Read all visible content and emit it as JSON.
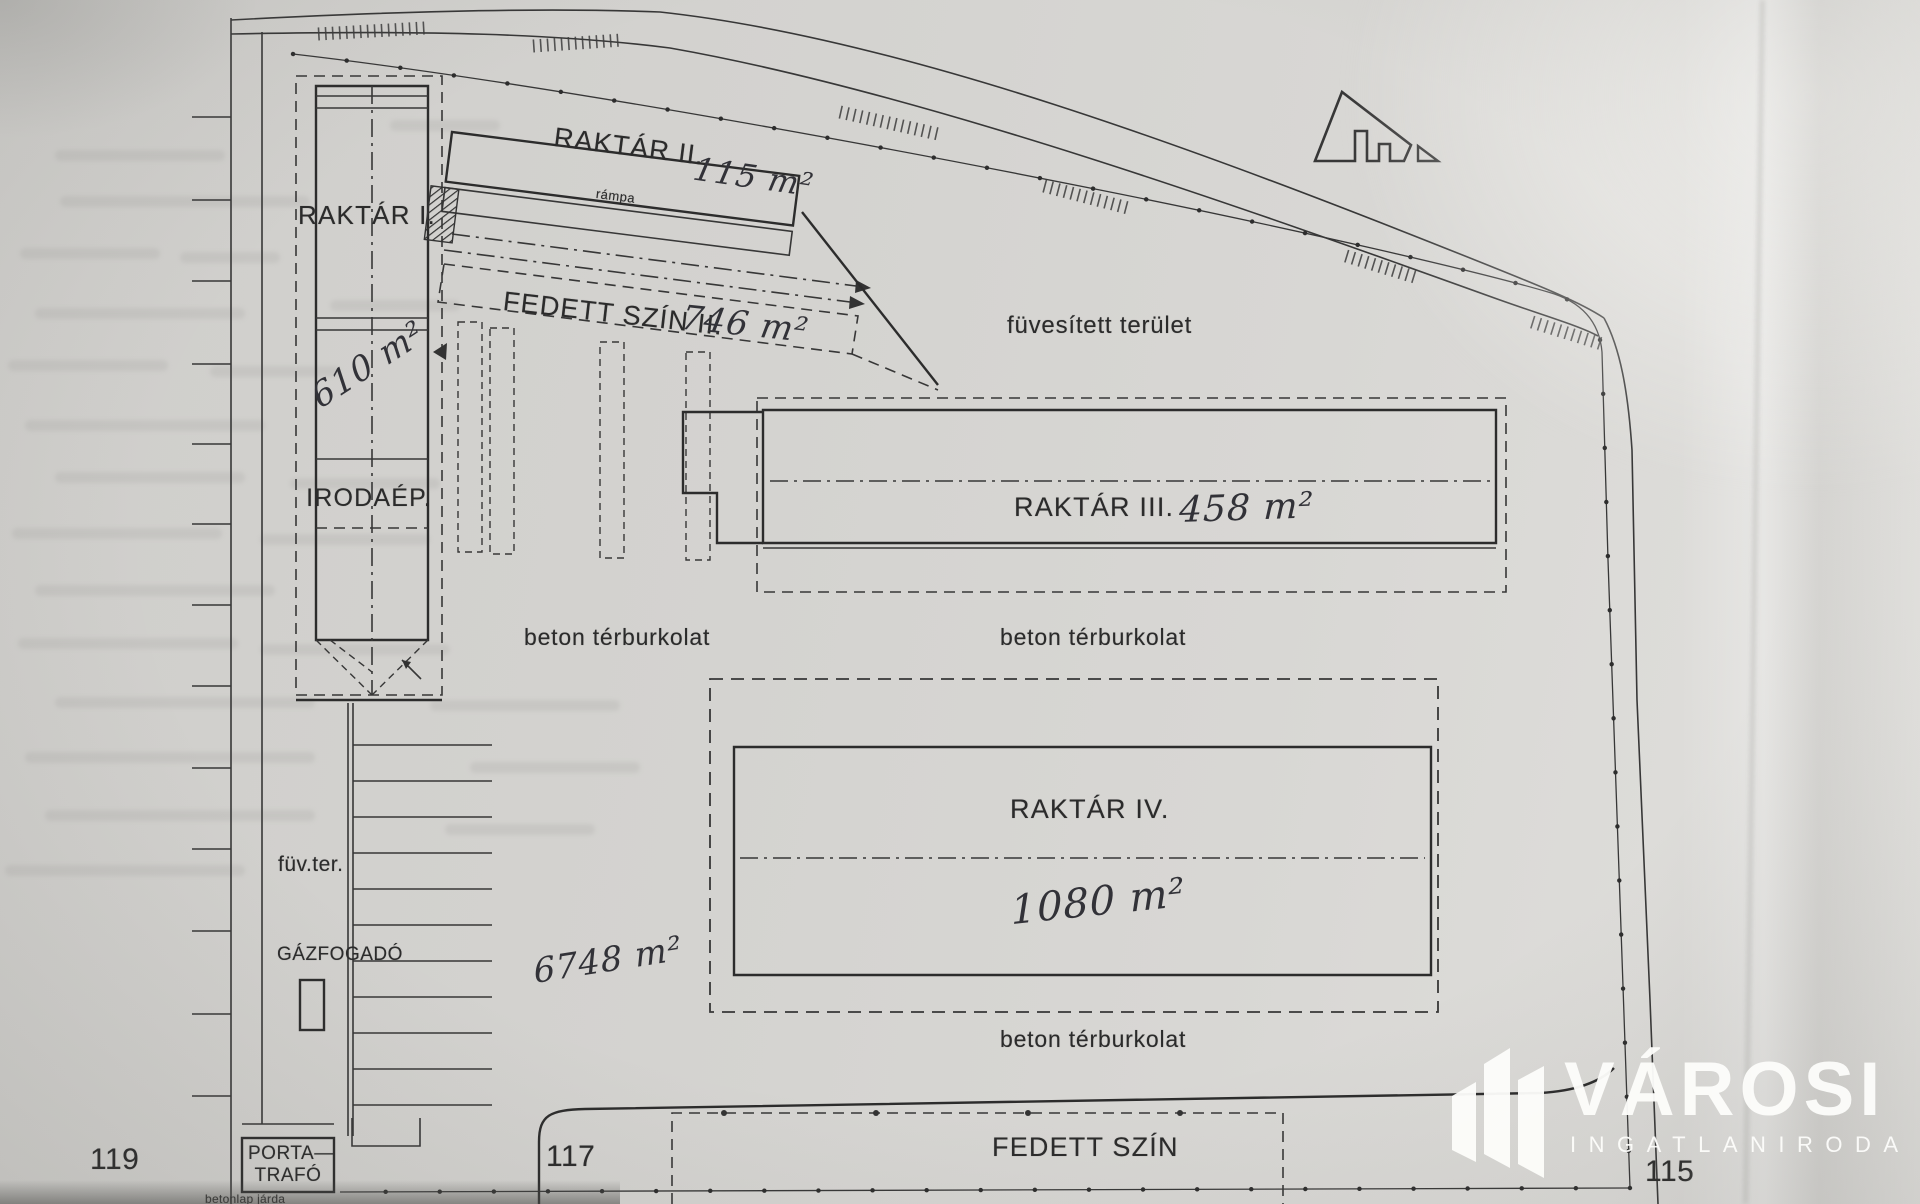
{
  "plan": {
    "buildings": {
      "raktar1": {
        "label": "RAKTÁR I.",
        "area": "610 m²"
      },
      "irodaep": {
        "label": "IRODAÉP."
      },
      "raktar2": {
        "label": "RAKTÁR II.",
        "area": "115 m²",
        "ramp": "rámpa"
      },
      "fedett_szin2": {
        "label": "FEDETT SZÍN II.",
        "area": "746 m²"
      },
      "raktar3": {
        "label": "RAKTÁR III.",
        "area": "458 m²"
      },
      "raktar4": {
        "label": "RAKTÁR IV.",
        "area": "1080 m²"
      },
      "fedett_szin": {
        "label": "FEDETT SZÍN"
      },
      "porta_trafo": {
        "line1": "PORTA—",
        "line2": "TRAFÓ"
      },
      "gazfogado": {
        "label": "GÁZFOGADÓ"
      }
    },
    "surfaces": {
      "fuvesitett_terulet": "füvesített terület",
      "beton_terburkolat": "beton térburkolat",
      "fuv_ter": "füv.ter.",
      "betonlap_jarda": "betonlap járda",
      "total_area": "6748 m²"
    },
    "parcel_numbers": [
      "119",
      "117",
      "115"
    ]
  },
  "watermark": {
    "name": "VÁROSI",
    "subtitle": "INGATLANIRODA"
  },
  "colors": {
    "paper": "#d4d3d0",
    "ink": "#333333",
    "watermark": "#fcfcfa"
  }
}
